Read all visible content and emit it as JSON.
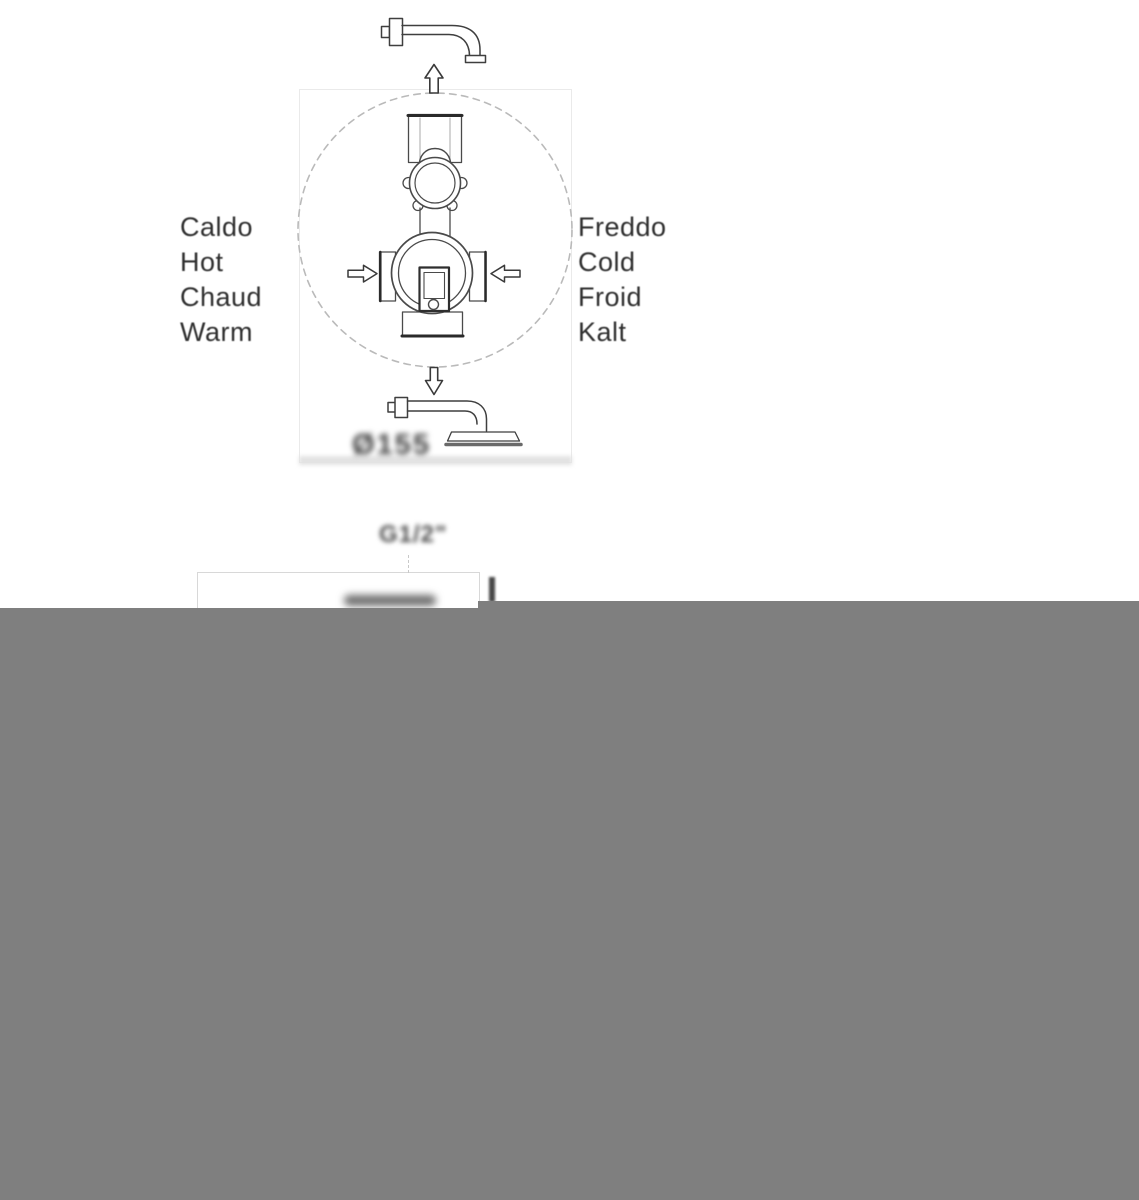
{
  "diagram": {
    "title_semantics": "concealed thermostatic shower valve installation schematic",
    "hot_labels": [
      "Caldo",
      "Hot",
      "Chaud",
      "Warm"
    ],
    "cold_labels": [
      "Freddo",
      "Cold",
      "Froid",
      "Kalt"
    ],
    "dimensions": {
      "diameter": "Ø155",
      "thread": "G1/2\""
    },
    "colors": {
      "line": "#3f3f3f",
      "heavy_line": "#2a2a2a",
      "dashed_circle": "#bababa",
      "label_text": "#2f2f2f",
      "redacted_gray": "#7f7f7f"
    }
  }
}
